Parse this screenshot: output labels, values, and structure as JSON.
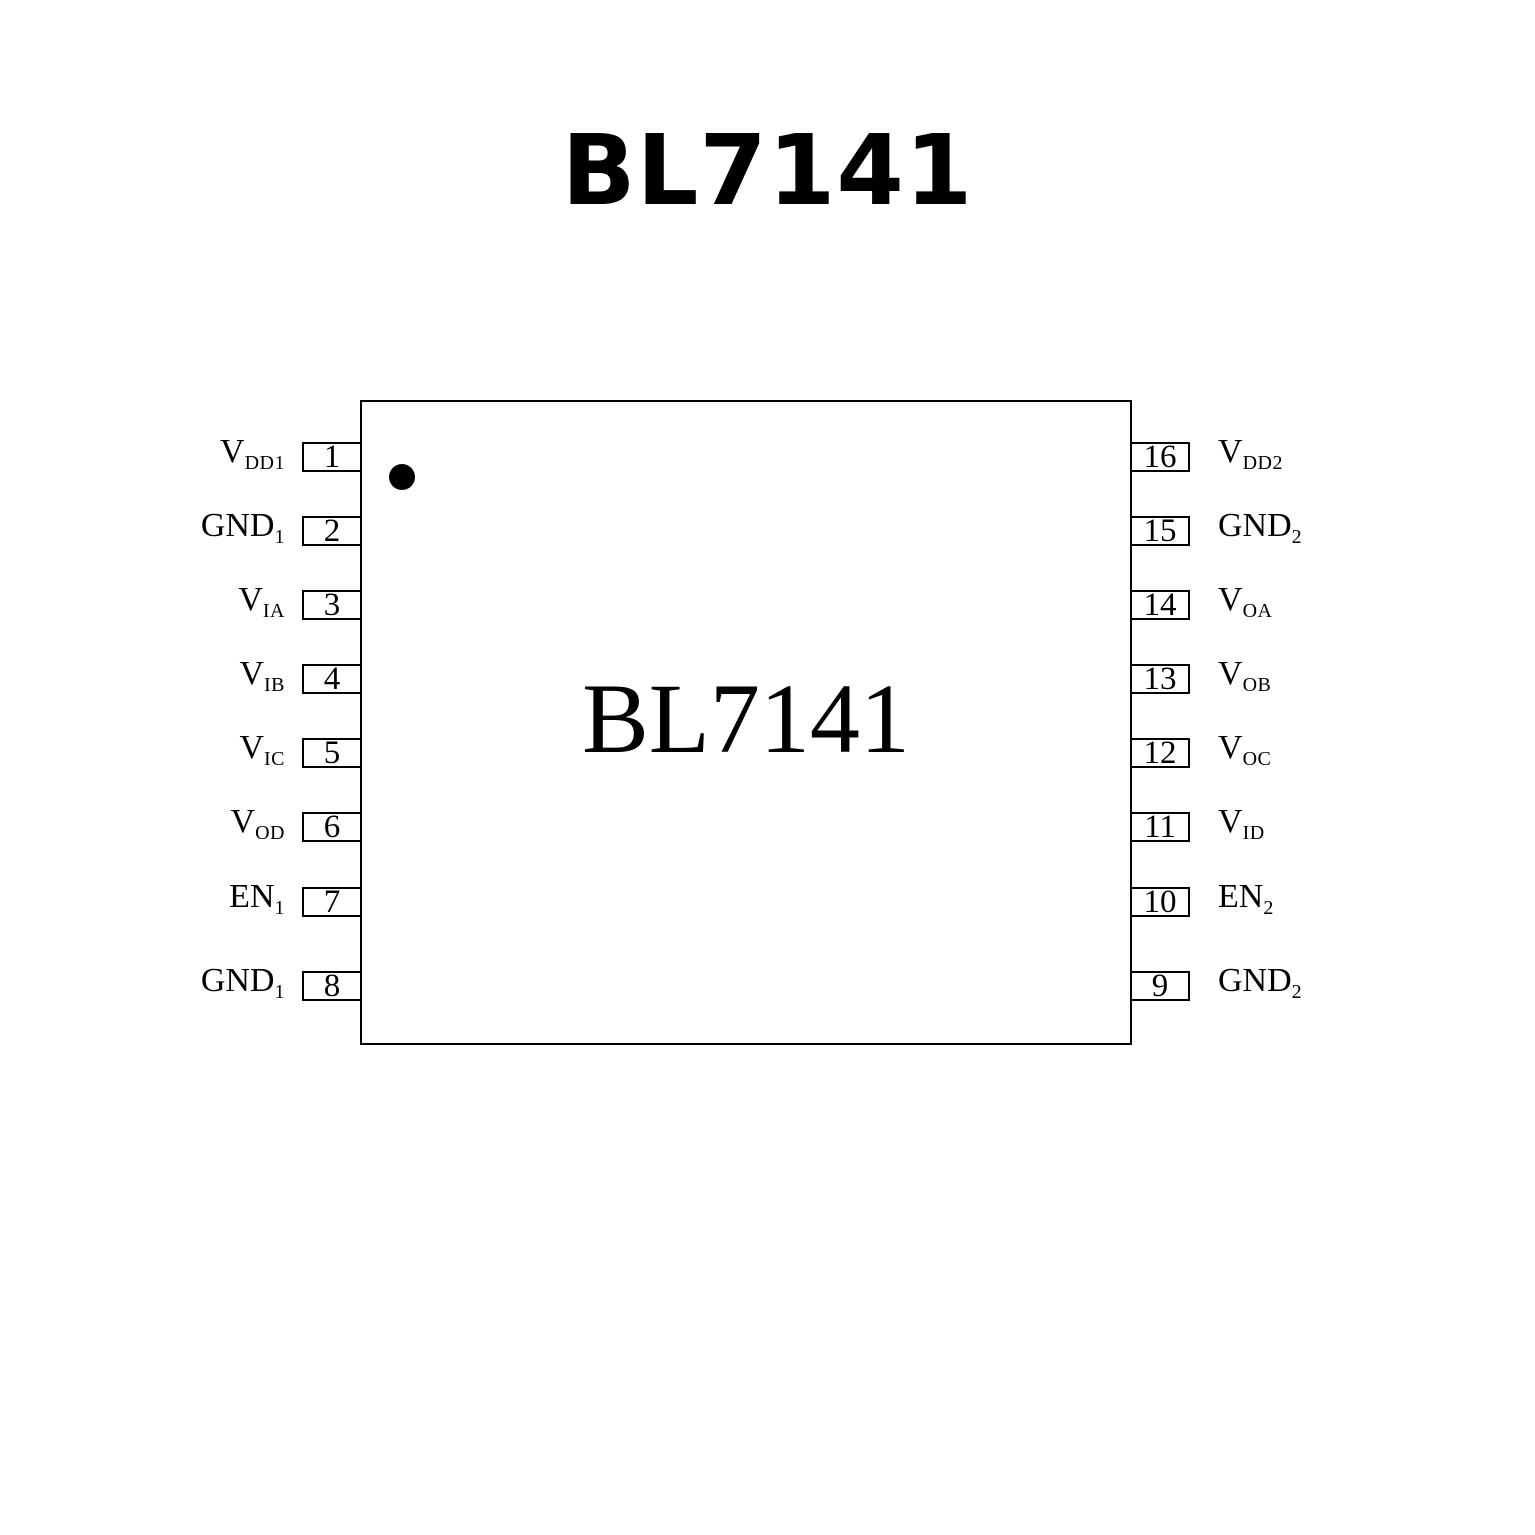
{
  "title": "BL7141",
  "chip": {
    "center_label": "BL7141",
    "left_pins": [
      {
        "number": "1",
        "name": "V",
        "sub": "DD1"
      },
      {
        "number": "2",
        "name": "GND",
        "sub": "1"
      },
      {
        "number": "3",
        "name": "V",
        "sub": "IA"
      },
      {
        "number": "4",
        "name": "V",
        "sub": "IB"
      },
      {
        "number": "5",
        "name": "V",
        "sub": "IC"
      },
      {
        "number": "6",
        "name": "V",
        "sub": "OD"
      },
      {
        "number": "7",
        "name": "EN",
        "sub": "1"
      },
      {
        "number": "8",
        "name": "GND",
        "sub": "1"
      }
    ],
    "right_pins": [
      {
        "number": "16",
        "name": "V",
        "sub": "DD2"
      },
      {
        "number": "15",
        "name": "GND",
        "sub": "2"
      },
      {
        "number": "14",
        "name": "V",
        "sub": "OA"
      },
      {
        "number": "13",
        "name": "V",
        "sub": "OB"
      },
      {
        "number": "12",
        "name": "V",
        "sub": "OC"
      },
      {
        "number": "11",
        "name": "V",
        "sub": "ID"
      },
      {
        "number": "10",
        "name": "EN",
        "sub": "2"
      },
      {
        "number": "9",
        "name": "GND",
        "sub": "2"
      }
    ]
  },
  "colors": {
    "line": "#000000",
    "background": "#ffffff",
    "text": "#000000"
  }
}
